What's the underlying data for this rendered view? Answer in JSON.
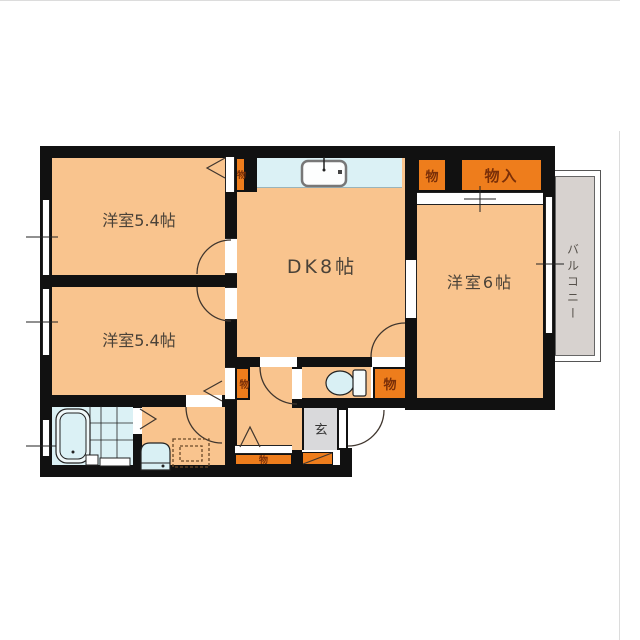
{
  "rooms": {
    "room_top_left": "洋室5.4帖",
    "room_bottom_left": "洋室5.4帖",
    "dining_kitchen": "DK8帖",
    "room_right": "洋室6帖",
    "balcony": "バルコニー",
    "entrance": "玄"
  },
  "closets": {
    "top_mid": "物",
    "top_right_small": "物",
    "top_right_large": "物入",
    "mid_left": "物",
    "mid_right": "物",
    "bottom": "物"
  },
  "colors": {
    "wall": "#111111",
    "room_fill": "#f9c48e",
    "closet_fill": "#ee7d1c",
    "water_fill": "#dbf1f5",
    "balcony_fill": "#d7d2cf",
    "entrance_fill": "#d9d9db",
    "closet_text": "#7a2f08",
    "room_text": "#4a4238"
  }
}
